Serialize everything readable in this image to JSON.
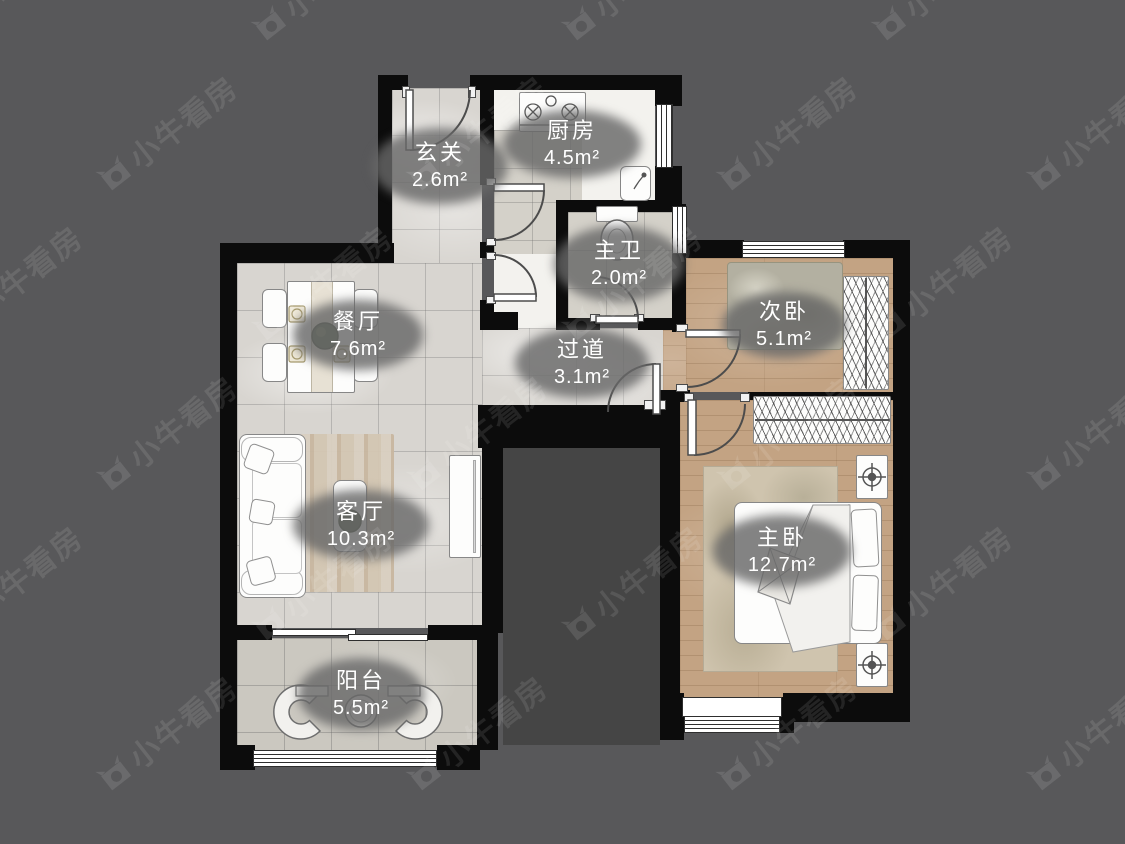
{
  "watermark": {
    "text": "小牛看房"
  },
  "rooms": [
    {
      "name": "玄关",
      "area": "2.6m²"
    },
    {
      "name": "厨房",
      "area": "4.5m²"
    },
    {
      "name": "主卫",
      "area": "2.0m²"
    },
    {
      "name": "餐厅",
      "area": "7.6m²"
    },
    {
      "name": "过道",
      "area": "3.1m²"
    },
    {
      "name": "次卧",
      "area": "5.1m²"
    },
    {
      "name": "客厅",
      "area": "10.3m²"
    },
    {
      "name": "主卧",
      "area": "12.7m²"
    },
    {
      "name": "阳台",
      "area": "5.5m²"
    }
  ],
  "colors": {
    "background": "#58585a",
    "wall": "#0c0c0c",
    "marble_floor": "#d8d5d0",
    "wood_floor": "#c3a383",
    "tile_floor": "#cbc8c0",
    "label_bubble": "#686868",
    "label_text": "#ffffff"
  }
}
